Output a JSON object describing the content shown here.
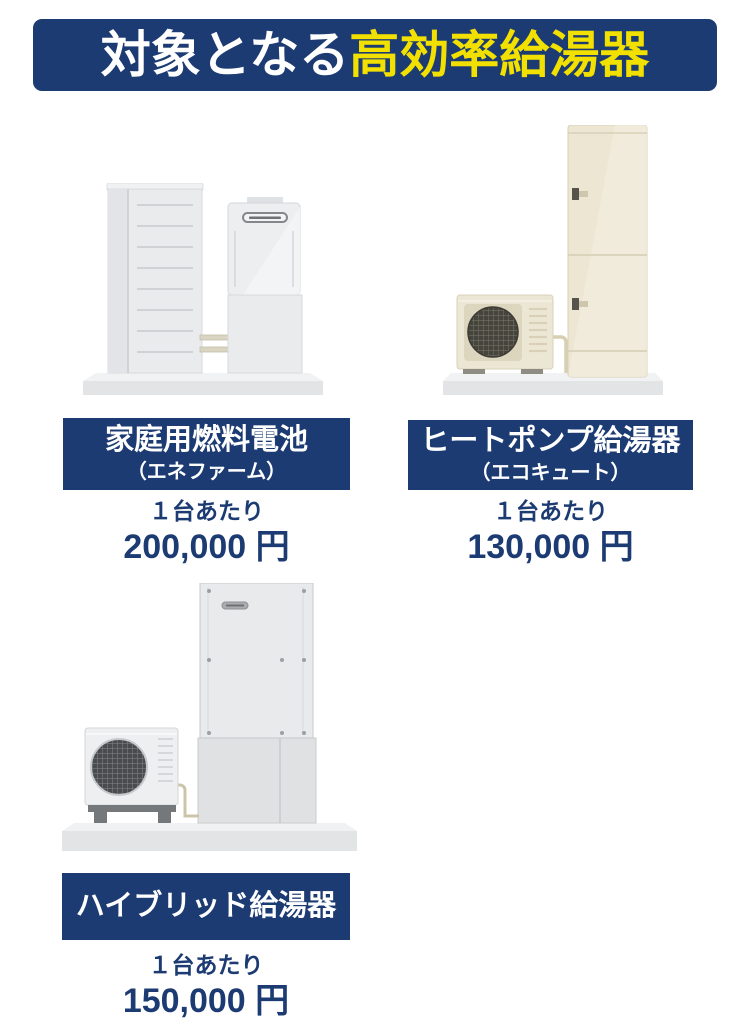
{
  "header": {
    "text_white": "対象となる",
    "text_yellow": "高効率給湯器"
  },
  "colors": {
    "navy": "#1c3b73",
    "highlight_yellow": "#f2e000",
    "label_text": "#ffffff",
    "price_text": "#1c3b73",
    "background": "#ffffff"
  },
  "products": [
    {
      "name": "家庭用燃料電池",
      "subname": "（エネファーム）",
      "unit_label": "１台あたり",
      "price": "200,000 円",
      "illustration": "fuel-cell-with-storage-unit-illustration"
    },
    {
      "name": "ヒートポンプ給湯器",
      "subname": "（エコキュート）",
      "unit_label": "１台あたり",
      "price": "130,000 円",
      "illustration": "heat-pump-outdoor-unit-with-tank-illustration"
    },
    {
      "name": "ハイブリッド給湯器",
      "unit_label": "１台あたり",
      "price": "150,000 円",
      "illustration": "hybrid-outdoor-unit-with-tank-illustration"
    }
  ]
}
